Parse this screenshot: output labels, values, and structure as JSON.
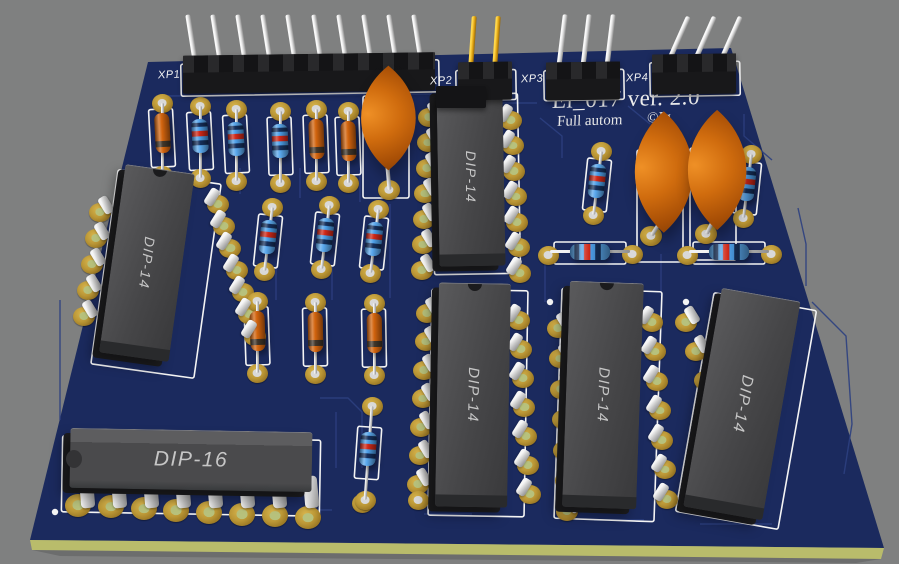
{
  "colors": {
    "background": "#7f8080",
    "board": "#1b2a5e",
    "board_edge": "#b9bc6b",
    "trace": "#2c3f80",
    "silkscreen": "#f4f4f4",
    "pad_gold": "#c3a03d",
    "pin_silver": "#e6e6e6",
    "pin_gold": "#e2a512",
    "chip_body": "#4b4b4d",
    "chip_side": "#1e1e20",
    "chip_label": "#c6c6c6",
    "resistor_orange": "#d2640e",
    "resistor_blue": "#3f97e6",
    "capacitor_orange": "#c8660c",
    "connector_black": "#18181a"
  },
  "board": {
    "face": "148,62 731,48 884,548 30,540",
    "edge": "30,540 884,548 881,559 32,550"
  },
  "title": {
    "line1": "El_017 ver. 2.0",
    "line2_left": "Full autom",
    "line2_right": "©Ig"
  },
  "connectors": [
    {
      "label": "XP1",
      "label_pos": [
        158,
        69
      ],
      "block": [
        183,
        54,
        252,
        38
      ],
      "silk": [
        181,
        62,
        258,
        32
      ],
      "pins": {
        "n": 10,
        "x0": 196,
        "dx": 25.2,
        "yb": 70,
        "h": 56,
        "rot": -9,
        "metal": "silver"
      }
    },
    {
      "label": "XP2",
      "label_pos": [
        430,
        75
      ],
      "block": [
        458,
        62,
        54,
        38
      ],
      "silk": [
        456,
        70,
        60,
        30
      ],
      "extra_block": [
        436,
        86,
        50,
        22
      ],
      "pins": {
        "n": 2,
        "x0": 470,
        "dx": 24,
        "yb": 70,
        "h": 54,
        "rot": 4,
        "metal": "gold"
      }
    },
    {
      "label": "XP3",
      "label_pos": [
        521,
        73
      ],
      "block": [
        546,
        62,
        74,
        38
      ],
      "silk": [
        544,
        70,
        80,
        30
      ],
      "pins": {
        "n": 3,
        "x0": 558,
        "dx": 24,
        "yb": 70,
        "h": 56,
        "rot": 7,
        "metal": "silver"
      }
    },
    {
      "label": "XP4",
      "label_pos": [
        626,
        72
      ],
      "block": [
        652,
        54,
        84,
        40
      ],
      "silk": [
        650,
        62,
        90,
        34
      ],
      "pins": {
        "n": 3,
        "x0": 666,
        "dx": 26,
        "yb": 66,
        "h": 54,
        "rot": 24,
        "metal": "silver"
      }
    }
  ],
  "chips": [
    {
      "label": "DIP-14",
      "body": [
        112,
        168,
        70,
        190
      ],
      "rot": 8,
      "label_rot": 97,
      "label_size": 14,
      "notch": true,
      "pads_left": {
        "x0": 100,
        "y0": 212,
        "dx": -4,
        "dy": 26,
        "n": 5
      },
      "pads_right": {
        "x0": 218,
        "y0": 204,
        "dx": 6.2,
        "dy": 22,
        "n": 7
      },
      "silk": [
        104,
        176,
        104,
        196
      ]
    },
    {
      "label": "DIP-14",
      "body": [
        438,
        88,
        66,
        178
      ],
      "rot": -1,
      "label_rot": 90,
      "label_size": 14,
      "notch": true,
      "pads_left": {
        "x0": 429,
        "y0": 117,
        "dx": -1.2,
        "dy": 25.5,
        "n": 7
      },
      "pads_right": {
        "x0": 511,
        "y0": 120,
        "dx": 1.5,
        "dy": 25.5,
        "n": 7
      },
      "silk": [
        433,
        94,
        86,
        180
      ]
    },
    {
      "label": "DIP-14",
      "body": [
        437,
        283,
        72,
        224
      ],
      "rot": 1,
      "label_rot": 91,
      "label_size": 15,
      "notch": true,
      "pads_left": {
        "x0": 427,
        "y0": 313,
        "dx": -1.5,
        "dy": 28.5,
        "n": 7
      },
      "pads_right": {
        "x0": 519,
        "y0": 320,
        "dx": 1.8,
        "dy": 29,
        "n": 7
      },
      "silk": [
        430,
        290,
        96,
        226
      ]
    },
    {
      "label": "DIP-14",
      "body": [
        566,
        282,
        74,
        226
      ],
      "rot": 2,
      "label_rot": 92,
      "label_size": 15,
      "notch": true,
      "pads_left": {
        "x0": 558,
        "y0": 328,
        "dx": 1.5,
        "dy": 30.5,
        "n": 7
      },
      "pads_right": {
        "x0": 652,
        "y0": 322,
        "dx": 2.5,
        "dy": 29.5,
        "n": 7
      },
      "silk": [
        558,
        290,
        100,
        230
      ]
    },
    {
      "label": "DIP-14",
      "body": [
        702,
        293,
        80,
        222
      ],
      "rot": 10,
      "label_rot": 100,
      "label_size": 16,
      "notch": false,
      "pads_left": {
        "x0": 686,
        "y0": 322,
        "dx": 9.7,
        "dy": 29,
        "n": 7
      },
      "pads_right": null,
      "silk": [
        694,
        300,
        104,
        222
      ]
    },
    {
      "label": "DIP-16",
      "body": [
        70,
        430,
        242,
        60
      ],
      "rot": 1,
      "label_rot": 1,
      "label_size": 21,
      "horizontal": true,
      "front_pins": {
        "n": 8,
        "x0": 80,
        "dx": 32,
        "y": 476
      },
      "front_pads": {
        "x0": 78,
        "y0": 505,
        "dx": 32.8,
        "dy": 1.8,
        "n": 8
      },
      "silk": [
        62,
        438,
        258,
        76
      ]
    }
  ],
  "resistors": [
    {
      "kind": "or",
      "x": 162,
      "y": 133,
      "rot": -3
    },
    {
      "kind": "bl",
      "x": 200,
      "y": 136,
      "rot": -3
    },
    {
      "kind": "bl",
      "x": 236,
      "y": 139,
      "rot": -3
    },
    {
      "kind": "bl",
      "x": 280,
      "y": 141,
      "rot": -2
    },
    {
      "kind": "or",
      "x": 316,
      "y": 139,
      "rot": -2
    },
    {
      "kind": "or",
      "x": 348,
      "y": 141,
      "rot": -2
    },
    {
      "kind": "bf",
      "x": 268,
      "y": 237,
      "rot": 6
    },
    {
      "kind": "bf",
      "x": 325,
      "y": 235,
      "rot": 6
    },
    {
      "kind": "bf",
      "x": 374,
      "y": 239,
      "rot": 6
    },
    {
      "kind": "or",
      "x": 257,
      "y": 331,
      "rot": -2
    },
    {
      "kind": "or",
      "x": 315,
      "y": 332,
      "rot": -1
    },
    {
      "kind": "or",
      "x": 374,
      "y": 333,
      "rot": -1
    },
    {
      "kind": "bf",
      "x": 368,
      "y": 449,
      "rot": 4,
      "pads": [
        [
          372,
          406
        ],
        [
          365,
          500
        ]
      ]
    },
    {
      "kind": "bf",
      "x": 597,
      "y": 181,
      "rot": 6
    },
    {
      "kind": "bf",
      "x": 747,
      "y": 184,
      "rot": 6
    },
    {
      "kind": "bh",
      "x": 590,
      "y": 252,
      "rot": 0
    },
    {
      "kind": "bh",
      "x": 729,
      "y": 252,
      "rot": 0
    }
  ],
  "capacitors": [
    {
      "cx": 388,
      "cy": 118,
      "w": 54,
      "h": 104,
      "pad": [
        389,
        190
      ],
      "lead_rot": -8,
      "silk": [
        363,
        96,
        46,
        102
      ]
    },
    {
      "cx": 664,
      "cy": 172,
      "w": 58,
      "h": 122,
      "pad": [
        651,
        236
      ],
      "lead_rot": -14,
      "silk": [
        637,
        150,
        46,
        112
      ]
    },
    {
      "cx": 717,
      "cy": 170,
      "w": 58,
      "h": 120,
      "pad": [
        706,
        234
      ],
      "lead_rot": -12,
      "silk": [
        690,
        148,
        46,
        112
      ]
    }
  ],
  "extra_pads": [
    [
      362,
      503
    ],
    [
      418,
      500
    ]
  ],
  "dots": [
    [
      55,
      512
    ],
    [
      686,
      302
    ],
    [
      550,
      302
    ]
  ],
  "traces": [
    "166,96 432,94",
    "443,103 537,103",
    "540,118 562,136 562,158",
    "628,106 650,124",
    "744,114 744,136 772,160",
    "798,208 806,244 806,286",
    "812,302 846,336 852,424 844,474",
    "240,168 240,194",
    "300,168 300,198",
    "360,170 360,202",
    "390,204 390,298",
    "276,266 276,300",
    "332,266 332,300",
    "545,262 545,302",
    "661,254 661,296",
    "60,300 60,420",
    "320,398 348,398 362,412 362,468",
    "336,412 336,468",
    "300,510 332,510",
    "424,514 472,514",
    "594,520 644,520",
    "700,524 772,524"
  ]
}
